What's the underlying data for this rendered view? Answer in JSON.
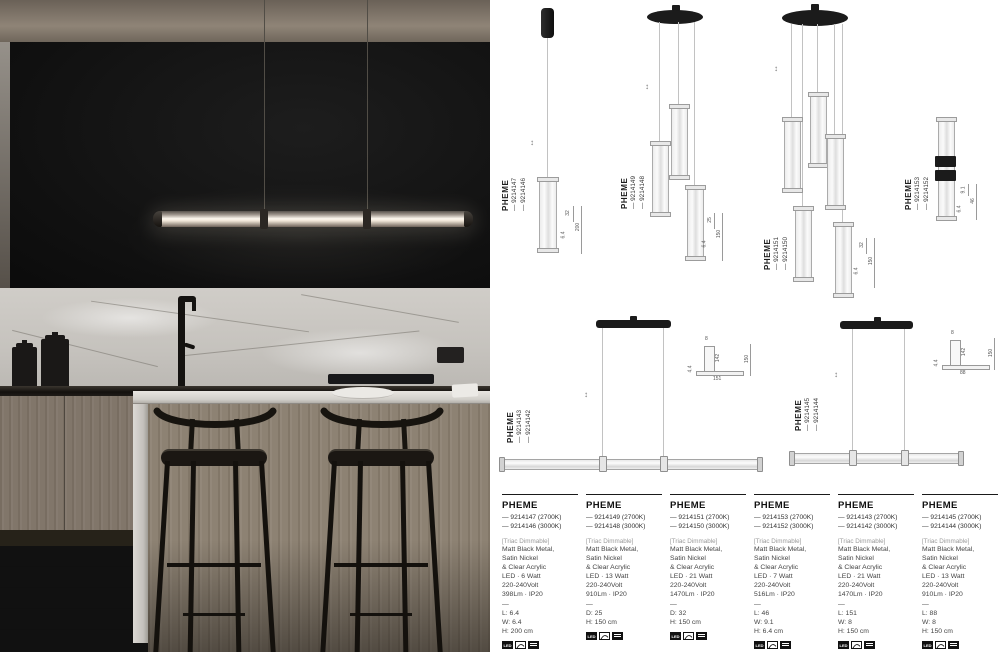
{
  "colors": {
    "page_bg": "#ffffff",
    "photo_wall": "#101010",
    "marble": "#cac7c2",
    "wood": "#8d8274",
    "lamp_glow": "#fdf8ef",
    "drawing_line": "#ababab"
  },
  "badges": {
    "led_label": "LED"
  },
  "drawings": [
    {
      "brand": "PHEME",
      "codes": [
        "— 9214147",
        "— 9214146"
      ],
      "dims": [
        "32",
        "6.4",
        "200"
      ]
    },
    {
      "brand": "PHEME",
      "codes": [
        "— 9214149",
        "— 9214148"
      ],
      "dims": [
        "25",
        "6.4",
        "150"
      ]
    },
    {
      "brand": "PHEME",
      "codes": [
        "— 9214151",
        "— 9214150"
      ],
      "dims": [
        "32",
        "6.4",
        "150"
      ]
    },
    {
      "brand": "PHEME",
      "codes": [
        "— 9214153",
        "— 9214152"
      ],
      "dims": [
        "9.1",
        "6.4",
        "46"
      ]
    },
    {
      "brand": "PHEME",
      "codes": [
        "— 9214143",
        "— 9214142"
      ],
      "dims": [
        "8",
        "142",
        "151",
        "150",
        "4.4"
      ]
    },
    {
      "brand": "PHEME",
      "codes": [
        "— 9214145",
        "— 9214144"
      ],
      "dims": [
        "8",
        "142",
        "88",
        "150",
        "4.4"
      ]
    }
  ],
  "products": [
    {
      "name": "PHEME",
      "variants": [
        "— 9214147 (2700K)",
        "— 9214146 (3000K)"
      ],
      "dimmable": "[Triac Dimmable]",
      "material": [
        "Matt Black Metal,",
        "Satin Nickel",
        "& Clear Acrylic"
      ],
      "electrical": [
        "LED · 6 Watt",
        "220-240Volt",
        "398Lm · IP20"
      ],
      "sep": "—",
      "size": [
        "L: 6.4",
        "W: 6.4",
        "H: 200 cm"
      ]
    },
    {
      "name": "PHEME",
      "variants": [
        "— 9214149 (2700K)",
        "— 9214148 (3000K)"
      ],
      "dimmable": "[Triac Dimmable]",
      "material": [
        "Matt Black Metal,",
        "Satin Nickel",
        "& Clear Acrylic"
      ],
      "electrical": [
        "LED · 13 Watt",
        "220-240Volt",
        "910Lm · IP20"
      ],
      "sep": "—",
      "size": [
        "D: 25",
        "H: 150 cm"
      ]
    },
    {
      "name": "PHEME",
      "variants": [
        "— 9214151 (2700K)",
        "— 9214150 (3000K)"
      ],
      "dimmable": "[Triac Dimmable]",
      "material": [
        "Matt Black Metal,",
        "Satin Nickel",
        "& Clear Acrylic"
      ],
      "electrical": [
        "LED · 21 Watt",
        "220-240Volt",
        "1470Lm · IP20"
      ],
      "sep": "—",
      "size": [
        "D: 32",
        "H: 150 cm"
      ]
    },
    {
      "name": "PHEME",
      "variants": [
        "— 9214153 (2700K)",
        "— 9214152 (3000K)"
      ],
      "dimmable": "[Triac Dimmable]",
      "material": [
        "Matt Black Metal,",
        "Satin Nickel",
        "& Clear Acrylic"
      ],
      "electrical": [
        "LED · 7 Watt",
        "220-240Volt",
        "516Lm · IP20"
      ],
      "sep": "—",
      "size": [
        "L: 46",
        "W: 9.1",
        "H: 6.4 cm"
      ]
    },
    {
      "name": "PHEME",
      "variants": [
        "— 9214143 (2700K)",
        "— 9214142 (3000K)"
      ],
      "dimmable": "[Triac Dimmable]",
      "material": [
        "Matt Black Metal,",
        "Satin Nickel",
        "& Clear Acrylic"
      ],
      "electrical": [
        "LED · 21 Watt",
        "220-240Volt",
        "1470Lm · IP20"
      ],
      "sep": "—",
      "size": [
        "L: 151",
        "W: 8",
        "H: 150 cm"
      ]
    },
    {
      "name": "PHEME",
      "variants": [
        "— 9214145 (2700K)",
        "— 9214144 (3000K)"
      ],
      "dimmable": "[Triac Dimmable]",
      "material": [
        "Matt Black Metal,",
        "Satin Nickel",
        "& Clear Acrylic"
      ],
      "electrical": [
        "LED · 13 Watt",
        "220-240Volt",
        "910Lm · IP20"
      ],
      "sep": "—",
      "size": [
        "L: 88",
        "W: 8",
        "H: 150 cm"
      ]
    }
  ]
}
